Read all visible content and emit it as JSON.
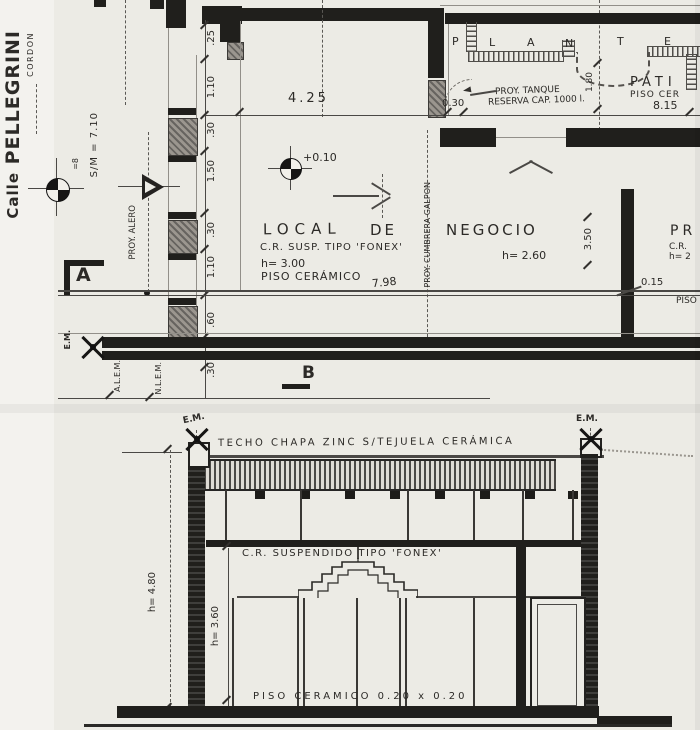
{
  "street": {
    "prefix": "Calle",
    "name": "PELLEGRINI",
    "cordon": "CORDON",
    "scale_note": "S/M = 7.10",
    "bench_note": "=8"
  },
  "plan": {
    "section_marker_a": "A",
    "section_marker_b": "B",
    "em_label": "E.M.",
    "proy_alero": "PROY. ALERO",
    "proy_cumbrera": "PROY. CUMBRERA GALPON",
    "alem": "A.L.E.M.",
    "nlem": "N.L.E.M.",
    "planter_letters": [
      "P",
      "L",
      "A",
      "N",
      "T",
      "E"
    ],
    "patio_name": "PATI",
    "patio_floor": "PISO CER",
    "tank_note_1": "PROY. TANQUE",
    "tank_note_2": "RESERVA CAP. 1000 l.",
    "room_line_1": "LOCAL",
    "room_line_2": "DE",
    "room_line_3": "NEGOCIO",
    "room_note_1": "C.R. SUSP. TIPO 'FONEX'",
    "room_note_2": "h= 3.00",
    "room_note_3": "PISO CERÁMICO",
    "room_note_4": "7.98",
    "level_note": "+0.10",
    "negocio_height": "h= 2.60",
    "edge_text_1": "PR",
    "edge_text_2": "C.R.",
    "edge_text_3": "h= 2",
    "edge_text_4": "PISO",
    "dims": {
      "top_width": "4.25",
      "wall": "0.30",
      "patio_width": "8.15",
      "patio_depth": "1.80",
      "bay": "3.50",
      "wall_thin": "0.15",
      "left_chain": [
        ".25",
        "1.10",
        ".30",
        "1.50",
        ".30",
        "1.10",
        ".60",
        ".30"
      ]
    }
  },
  "section": {
    "em_label": "E.M.",
    "roof_note": "TECHO CHAPA ZINC S/TEJUELA CERÁMICA",
    "ceiling_note": "C.R. SUSPENDIDO TIPO 'FONEX'",
    "floor_note": "PISO CERAMICO 0.20 x 0.20",
    "height_total": "h= 4.80",
    "height_interior": "h= 3.60"
  }
}
